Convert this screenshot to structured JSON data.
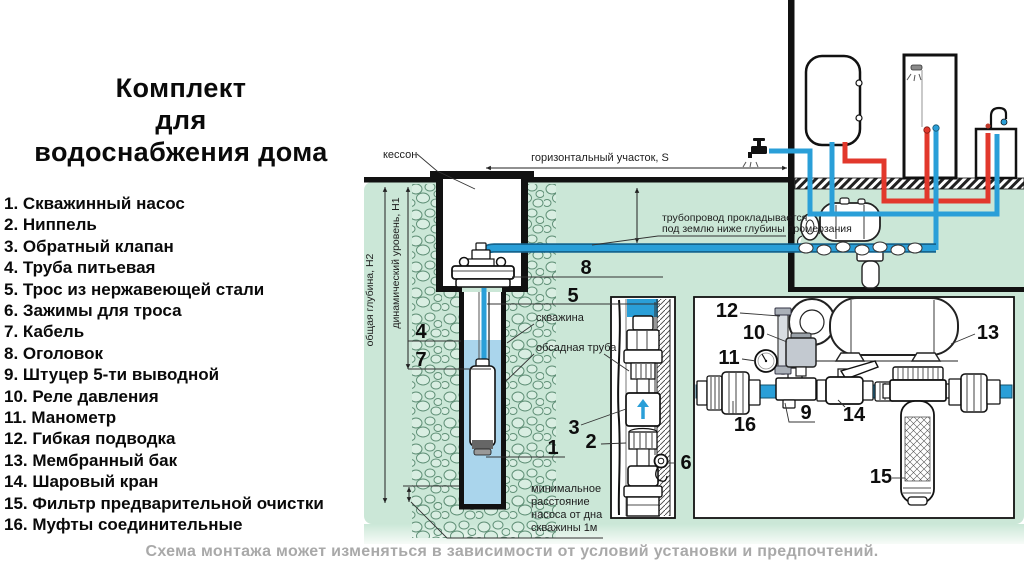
{
  "title": {
    "line1": "Комплект",
    "line2": "для",
    "line3": "водоснабжения дома"
  },
  "parts_list": {
    "items": [
      "1. Скважинный насос",
      "2. Ниппель",
      "3. Обратный клапан",
      "4. Труба питьевая",
      "5. Трос из нержавеющей стали",
      "6. Зажимы для троса",
      "7. Кабель",
      "8. Оголовок",
      "9. Штуцер 5-ти выводной",
      "10. Реле давления",
      "11. Манометр",
      "12. Гибкая подводка",
      "13. Мембранный бак",
      "14. Шаровый кран",
      "15. Фильтр предварительной очистки",
      "16. Муфты соединительные"
    ]
  },
  "diagram": {
    "labels": {
      "caisson": "кессон",
      "horizontal_section": "горизонтальный участок, S",
      "pipeline_note_line1": "трубопровод прокладывается",
      "pipeline_note_line2": "под землю ниже глубины промерзания",
      "well": "скважина",
      "casing_pipe": "обсадная труба",
      "total_depth": "общая глубина, Н2",
      "dynamic_level": "динамический уровень, Н1",
      "min_distance_line1": "минимальное",
      "min_distance_line2": "расстояние",
      "min_distance_line3": "насоса от дна",
      "min_distance_line4": "скважины 1м"
    },
    "callouts": {
      "c1": "1",
      "c2": "2",
      "c3": "3",
      "c4": "4",
      "c5": "5",
      "c6": "6",
      "c7": "7",
      "c8": "8",
      "c9": "9",
      "c10": "10",
      "c11": "11",
      "c12": "12",
      "c13": "13",
      "c14": "14",
      "c15": "15",
      "c16": "16"
    },
    "colors": {
      "ground": "#cbe7d7",
      "cold_pipe": "#2a9fd8",
      "hot_pipe": "#e2382c",
      "well_water": "#aad5ec"
    }
  },
  "footer": {
    "note": "Схема монтажа может изменяться в зависимости от условий установки и предпочтений."
  }
}
